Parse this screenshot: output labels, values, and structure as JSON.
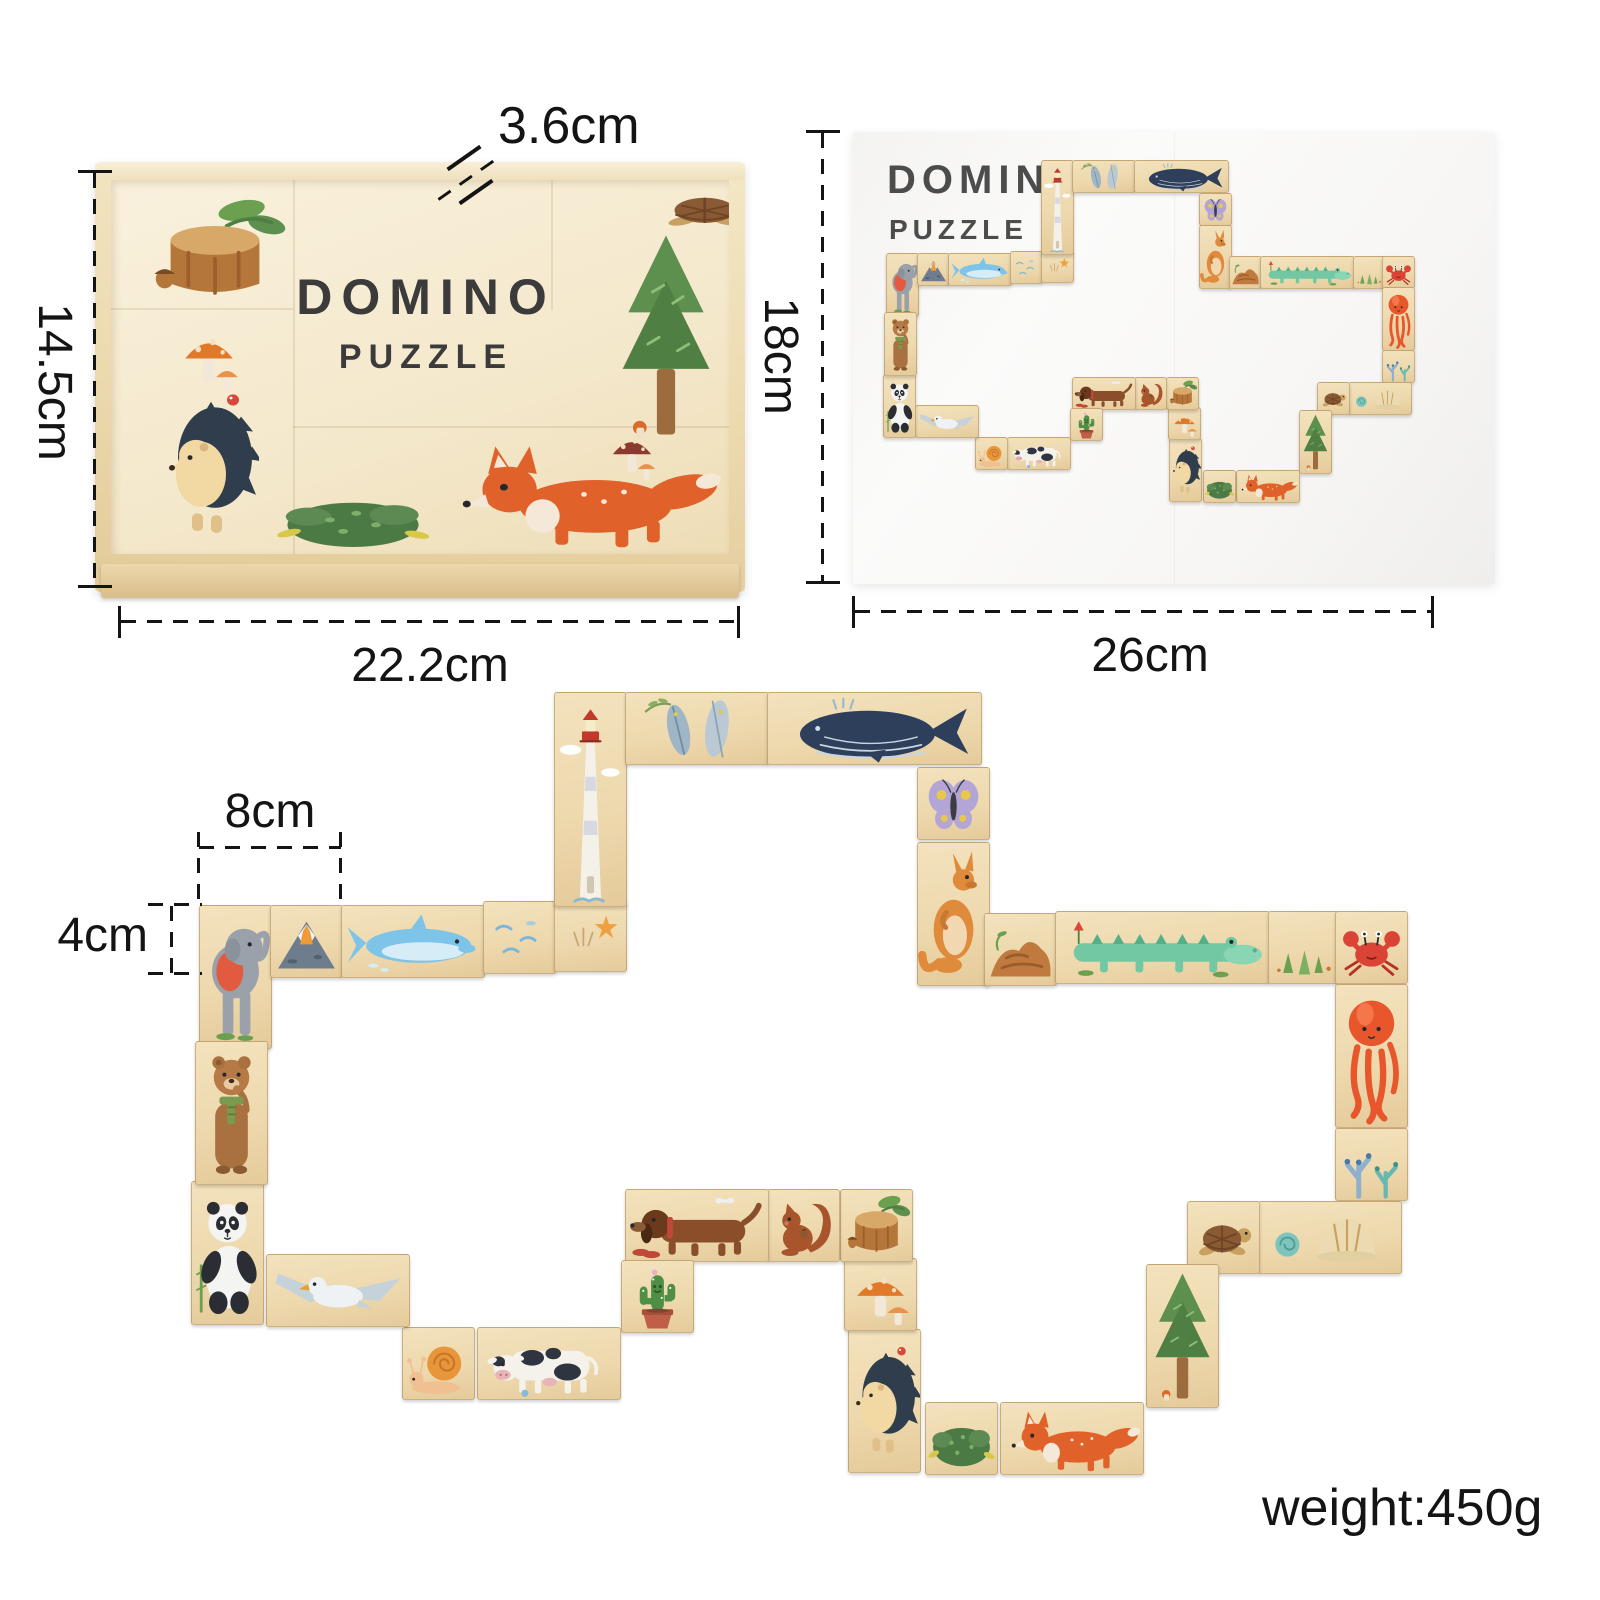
{
  "box": {
    "title1": "DOMINO",
    "title2": "PUZZLE",
    "art": [
      {
        "name": "tree-stump",
        "shape": "stump",
        "x": 30,
        "y": 10,
        "w": 148,
        "h": 120,
        "u": [
          1,
          1
        ],
        "colors": [
          "#b5763a",
          "#d8a868"
        ]
      },
      {
        "name": "mushrooms",
        "shape": "mushroom",
        "x": 62,
        "y": 138,
        "w": 72,
        "h": 78,
        "u": [
          1,
          1
        ],
        "colors": [
          "#e07a2a",
          "#f2e8d8"
        ]
      },
      {
        "name": "hedgehog",
        "shape": "hedgehog",
        "x": 48,
        "y": 192,
        "w": 100,
        "h": 186,
        "u": [
          1,
          2
        ],
        "colors": [
          "#f2d8a2",
          "#2f3d4c"
        ]
      },
      {
        "name": "bush",
        "shape": "bush",
        "x": 160,
        "y": 294,
        "w": 164,
        "h": 82,
        "u": [
          1,
          1
        ],
        "colors": [
          "#4c7a45",
          "#7fae6a"
        ]
      },
      {
        "name": "fox",
        "shape": "fox",
        "x": 330,
        "y": 252,
        "w": 286,
        "h": 120,
        "u": [
          2,
          1
        ],
        "colors": [
          "#e0622a",
          "#f6e8d8"
        ]
      },
      {
        "name": "pine-tree",
        "shape": "tree",
        "x": 498,
        "y": 42,
        "w": 114,
        "h": 226,
        "u": [
          1,
          2
        ],
        "colors": [
          "#5d8f4f",
          "#9c6b3e"
        ]
      },
      {
        "name": "small-mushrooms",
        "shape": "mushroom",
        "x": 492,
        "y": 242,
        "w": 58,
        "h": 62,
        "u": [
          1,
          1
        ],
        "colors": [
          "#8a3a2e",
          "#f2e8d8"
        ]
      },
      {
        "name": "turtle",
        "shape": "turtle",
        "x": 540,
        "y": -4,
        "w": 112,
        "h": 66,
        "u": [
          1,
          1
        ],
        "colors": [
          "#8a5a34",
          "#c8a060"
        ]
      }
    ]
  },
  "poster": {
    "title1": "DOMINO",
    "title2": "PUZZLE"
  },
  "dims": {
    "box_depth": "3.6cm",
    "box_height": "14.5cm",
    "box_width": "22.2cm",
    "poster_height": "18cm",
    "poster_width": "26cm",
    "piece_length": "8cm",
    "piece_height": "4cm"
  },
  "weight": "weight:450g",
  "colors": {
    "background": "#ffffff",
    "wood_light": "#f3e2bd",
    "wood_dark": "#e5cb9b",
    "annotation_line": "#141414",
    "box_title": "#3b3b3b",
    "poster_title": "#4c4c4c"
  },
  "big_loop": {
    "origin_x": 199,
    "origin_y": 692,
    "cell": 71
  },
  "poster_loop": {
    "origin_x": 886,
    "origin_y": 160,
    "cell": 31
  },
  "tiles": [
    {
      "name": "elephant",
      "shape": "elephant",
      "c": 0,
      "r": 3,
      "w": 1,
      "h": 2,
      "dx": 0,
      "dy": 0,
      "colors": [
        "#9aa1ab",
        "#e25b40"
      ]
    },
    {
      "name": "volcano",
      "shape": "volcano",
      "c": 1,
      "r": 3,
      "w": 1,
      "h": 1,
      "dx": 0,
      "dy": 0,
      "colors": [
        "#6e7d8e",
        "#f09a38"
      ]
    },
    {
      "name": "dolphin",
      "shape": "dolphin",
      "c": 2,
      "r": 3,
      "w": 2,
      "h": 1,
      "dx": 0,
      "dy": 0,
      "colors": [
        "#7ec3e8",
        "#d6edf8"
      ]
    },
    {
      "name": "waves",
      "shape": "waves",
      "c": 4,
      "r": 3,
      "w": 1,
      "h": 1,
      "dx": 0,
      "dy": -4,
      "colors": [
        "#7ab8d8",
        "#a6cede"
      ]
    },
    {
      "name": "shell-starfish",
      "shape": "shellstar",
      "c": 5,
      "r": 3,
      "w": 1,
      "h": 1,
      "dx": 0,
      "dy": -6,
      "colors": [
        "#ecd9b4",
        "#efa040"
      ]
    },
    {
      "name": "lighthouse",
      "shape": "lighthouse",
      "c": 5,
      "r": 0,
      "w": 1,
      "h": 3,
      "dx": 0,
      "dy": 0,
      "colors": [
        "#f4f1e8",
        "#c0392b"
      ]
    },
    {
      "name": "feathers",
      "shape": "feathers",
      "c": 6,
      "r": 0,
      "w": 2,
      "h": 1,
      "dx": 0,
      "dy": 0,
      "colors": [
        "#9fb6c6",
        "#bac9d4"
      ]
    },
    {
      "name": "whale",
      "shape": "whale",
      "c": 8,
      "r": 0,
      "w": 3,
      "h": 1,
      "dx": 0,
      "dy": 0,
      "colors": [
        "#2e3f5c",
        "#c8d4de"
      ]
    },
    {
      "name": "butterfly",
      "shape": "butterfly",
      "c": 10,
      "r": 1,
      "w": 1,
      "h": 1,
      "dx": 8,
      "dy": 4,
      "colors": [
        "#b3a5d6",
        "#e8c84a"
      ]
    },
    {
      "name": "kangaroo",
      "shape": "kangaroo",
      "c": 10,
      "r": 2,
      "w": 1,
      "h": 2,
      "dx": 8,
      "dy": 8,
      "colors": [
        "#e08a3c",
        "#f2d8b0"
      ]
    },
    {
      "name": "rock",
      "shape": "rock",
      "c": 11,
      "r": 3,
      "w": 1,
      "h": 1,
      "dx": 4,
      "dy": 8,
      "colors": [
        "#c07a40",
        "#9a5c28"
      ]
    },
    {
      "name": "crocodile",
      "shape": "croc",
      "c": 12,
      "r": 3,
      "w": 3,
      "h": 1,
      "dx": 4,
      "dy": 6,
      "colors": [
        "#72c8a2",
        "#55b08a"
      ]
    },
    {
      "name": "seagrass",
      "shape": "grass",
      "c": 15,
      "r": 3,
      "w": 1,
      "h": 1,
      "dx": 4,
      "dy": 6,
      "colors": [
        "#6aa050",
        "#7ab060"
      ]
    },
    {
      "name": "crab",
      "shape": "crab",
      "c": 16,
      "r": 3,
      "w": 1,
      "h": 1,
      "dx": 0,
      "dy": 6,
      "colors": [
        "#d94436",
        "#b33224"
      ]
    },
    {
      "name": "octopus",
      "shape": "octopus",
      "c": 16,
      "r": 4,
      "w": 1,
      "h": 2,
      "dx": 0,
      "dy": 8,
      "colors": [
        "#e8562c",
        "#f4764a"
      ]
    },
    {
      "name": "coral",
      "shape": "coral",
      "c": 16,
      "r": 6,
      "w": 1,
      "h": 1,
      "dx": 0,
      "dy": 10,
      "colors": [
        "#8fb0cc",
        "#68b8b0"
      ]
    },
    {
      "name": "shells",
      "shape": "shell",
      "c": 15,
      "r": 7,
      "w": 2,
      "h": 1,
      "dx": -6,
      "dy": 12,
      "colors": [
        "#ecdab2",
        "#7cc4bc"
      ]
    },
    {
      "name": "turtle",
      "shape": "turtle",
      "c": 14,
      "r": 7,
      "w": 1,
      "h": 1,
      "dx": -6,
      "dy": 12,
      "colors": [
        "#8a5a34",
        "#c8a060"
      ]
    },
    {
      "name": "pine-tree",
      "shape": "tree",
      "c": 13,
      "r": 8,
      "w": 1,
      "h": 2,
      "dx": 24,
      "dy": 4,
      "colors": [
        "#5d8f4f",
        "#9c6b3e"
      ]
    },
    {
      "name": "fox",
      "shape": "fox",
      "c": 11,
      "r": 10,
      "w": 2,
      "h": 1,
      "dx": 20,
      "dy": 0,
      "colors": [
        "#e0622a",
        "#f6e8d8"
      ]
    },
    {
      "name": "bush",
      "shape": "bush",
      "c": 10,
      "r": 10,
      "w": 1,
      "h": 1,
      "dx": 16,
      "dy": 0,
      "colors": [
        "#4c7a45",
        "#7fae6a"
      ]
    },
    {
      "name": "hedgehog",
      "shape": "hedgehog",
      "c": 9,
      "r": 9,
      "w": 1,
      "h": 2,
      "dx": 10,
      "dy": -2,
      "colors": [
        "#f2d8a2",
        "#2f3d4c"
      ]
    },
    {
      "name": "mushrooms",
      "shape": "mushroom",
      "c": 9,
      "r": 8,
      "w": 1,
      "h": 1,
      "dx": 6,
      "dy": -2,
      "colors": [
        "#e07a2a",
        "#f2e8d8"
      ]
    },
    {
      "name": "tree-stump",
      "shape": "stump",
      "c": 9,
      "r": 7,
      "w": 1,
      "h": 1,
      "dx": 2,
      "dy": 0,
      "colors": [
        "#b5763a",
        "#d8a868"
      ]
    },
    {
      "name": "squirrel",
      "shape": "squirrel",
      "c": 8,
      "r": 7,
      "w": 1,
      "h": 1,
      "dx": 0,
      "dy": 0,
      "colors": [
        "#a8542c",
        "#c9742a"
      ]
    },
    {
      "name": "dachshund",
      "shape": "dog",
      "c": 6,
      "r": 7,
      "w": 2,
      "h": 1,
      "dx": 0,
      "dy": 0,
      "colors": [
        "#8a4f2a",
        "#6b3a1c"
      ]
    },
    {
      "name": "cactus",
      "shape": "cactus",
      "c": 6,
      "r": 8,
      "w": 1,
      "h": 1,
      "dx": -4,
      "dy": 0,
      "colors": [
        "#4f8f45",
        "#bf5f48"
      ]
    },
    {
      "name": "cow",
      "shape": "cow",
      "c": 4,
      "r": 9,
      "w": 2,
      "h": 1,
      "dx": -6,
      "dy": -4,
      "colors": [
        "#f5f2ec",
        "#2e3440"
      ]
    },
    {
      "name": "snail",
      "shape": "snail",
      "c": 3,
      "r": 9,
      "w": 1,
      "h": 1,
      "dx": -10,
      "dy": -4,
      "colors": [
        "#e8963a",
        "#f0c090"
      ]
    },
    {
      "name": "seagull",
      "shape": "seagull",
      "c": 1,
      "r": 8,
      "w": 2,
      "h": 1,
      "dx": -4,
      "dy": -6,
      "colors": [
        "#eef2f4",
        "#c6d2da"
      ]
    },
    {
      "name": "panda",
      "shape": "panda",
      "c": 0,
      "r": 7,
      "w": 1,
      "h": 2,
      "dx": -8,
      "dy": -8,
      "colors": [
        "#f4f4f2",
        "#2a2e34"
      ]
    },
    {
      "name": "bear",
      "shape": "bear",
      "c": 0,
      "r": 5,
      "w": 1,
      "h": 2,
      "dx": -4,
      "dy": -6,
      "colors": [
        "#a9713f",
        "#7a9a50"
      ]
    }
  ]
}
